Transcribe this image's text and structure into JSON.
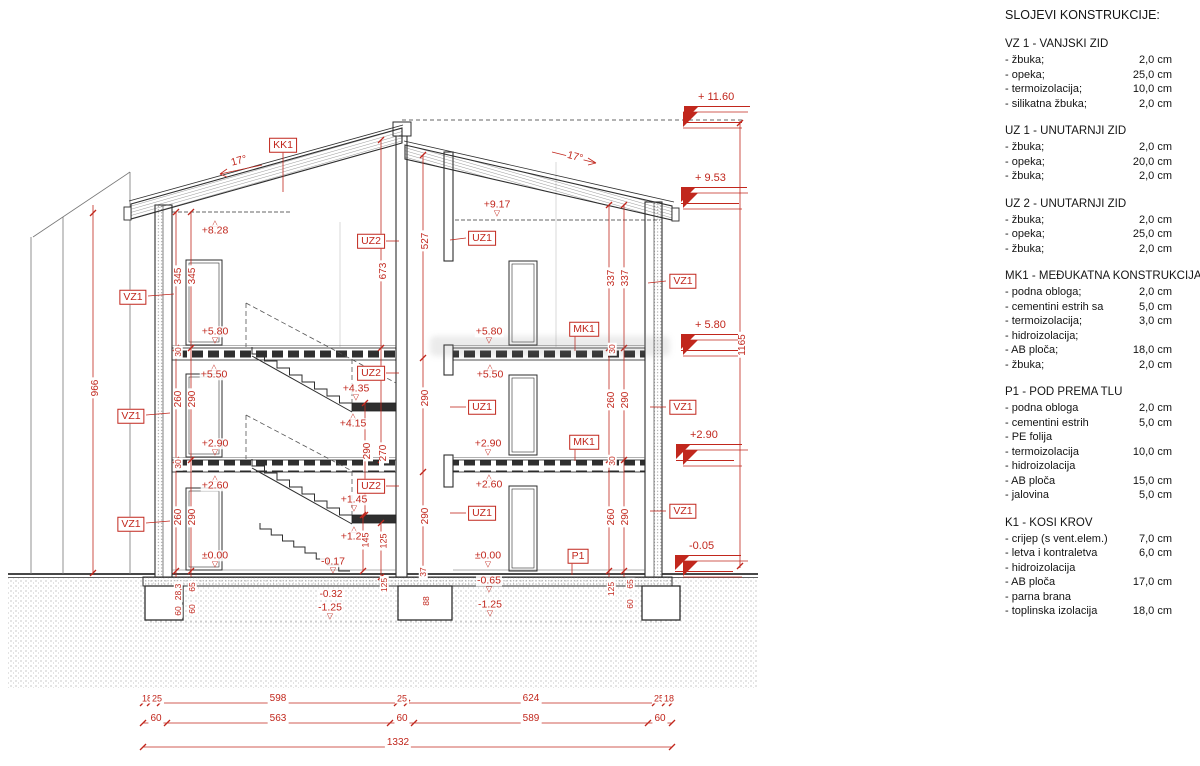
{
  "colors": {
    "annotation_red": "#c1271d",
    "line_black": "#2e2e2e",
    "background": "#ffffff"
  },
  "legend": {
    "title": "SLOJEVI KONSTRUKCIJE:",
    "sections": [
      {
        "heading": "VZ 1 - VANJSKI ZID",
        "rows": [
          {
            "label": "- žbuka;",
            "value": "2,0 cm"
          },
          {
            "label": "- opeka;",
            "value": "25,0 cm"
          },
          {
            "label": "- termoizolacija;",
            "value": "10,0 cm"
          },
          {
            "label": "- silikatna žbuka;",
            "value": "2,0 cm"
          }
        ]
      },
      {
        "heading": "UZ 1 - UNUTARNJI ZID",
        "rows": [
          {
            "label": "- žbuka;",
            "value": "2,0 cm"
          },
          {
            "label": "- opeka;",
            "value": "20,0 cm"
          },
          {
            "label": "- žbuka;",
            "value": "2,0 cm"
          }
        ]
      },
      {
        "heading": "UZ 2 - UNUTARNJI ZID",
        "rows": [
          {
            "label": "- žbuka;",
            "value": "2,0 cm"
          },
          {
            "label": "- opeka;",
            "value": "25,0 cm"
          },
          {
            "label": "- žbuka;",
            "value": "2,0 cm"
          }
        ]
      },
      {
        "heading": "MK1 - MEĐUKATNA KONSTRUKCIJA",
        "rows": [
          {
            "label": "- podna obloga;",
            "value": "2,0 cm"
          },
          {
            "label": "- cementini estrih sa",
            "value": "5,0 cm"
          },
          {
            "label": "- termoizolacija;",
            "value": "3,0 cm"
          },
          {
            "label": "- hidroizolacija;",
            "value": ""
          },
          {
            "label": "- AB ploča;",
            "value": "18,0 cm"
          },
          {
            "label": "- žbuka;",
            "value": "2,0 cm"
          }
        ]
      },
      {
        "heading": "P1 - POD PREMA TLU",
        "rows": [
          {
            "label": "- podna obloga",
            "value": "2,0 cm"
          },
          {
            "label": "- cementini estrih",
            "value": "5,0 cm"
          },
          {
            "label": "- PE folija",
            "value": ""
          },
          {
            "label": "- termoizolacija",
            "value": "10,0 cm"
          },
          {
            "label": "- hidroizolacija",
            "value": ""
          },
          {
            "label": "- AB ploča",
            "value": "15,0 cm"
          },
          {
            "label": "- jalovina",
            "value": "5,0 cm"
          }
        ]
      },
      {
        "heading": "K1 - KOSI KROV",
        "rows": [
          {
            "label": "- crijep (s vent.elem.)",
            "value": "7,0 cm"
          },
          {
            "label": "- letva i kontraletva",
            "value": "6,0 cm"
          },
          {
            "label": "- hidroizolacija",
            "value": ""
          },
          {
            "label": "- AB ploča",
            "value": "17,0 cm"
          },
          {
            "label": "- parna brana",
            "value": ""
          },
          {
            "label": "- toplinska izolacija",
            "value": "18,0 cm"
          }
        ]
      }
    ]
  },
  "annotations": [
    {
      "t": "KK1",
      "x": 283,
      "y": 145,
      "k": "box"
    },
    {
      "t": "VZ1",
      "x": 133,
      "y": 297,
      "k": "box"
    },
    {
      "t": "VZ1",
      "x": 131,
      "y": 416,
      "k": "box"
    },
    {
      "t": "VZ1",
      "x": 131,
      "y": 524,
      "k": "box"
    },
    {
      "t": "UZ2",
      "x": 371,
      "y": 241,
      "k": "box"
    },
    {
      "t": "UZ2",
      "x": 371,
      "y": 373,
      "k": "box"
    },
    {
      "t": "UZ2",
      "x": 371,
      "y": 486,
      "k": "box"
    },
    {
      "t": "UZ1",
      "x": 482,
      "y": 238,
      "k": "box"
    },
    {
      "t": "UZ1",
      "x": 482,
      "y": 407,
      "k": "box"
    },
    {
      "t": "UZ1",
      "x": 482,
      "y": 513,
      "k": "box"
    },
    {
      "t": "VZ1",
      "x": 683,
      "y": 281,
      "k": "box"
    },
    {
      "t": "VZ1",
      "x": 683,
      "y": 407,
      "k": "box"
    },
    {
      "t": "VZ1",
      "x": 683,
      "y": 511,
      "k": "box"
    },
    {
      "t": "MK1",
      "x": 584,
      "y": 329,
      "k": "box"
    },
    {
      "t": "MK1",
      "x": 584,
      "y": 442,
      "k": "box"
    },
    {
      "t": "P1",
      "x": 578,
      "y": 556,
      "k": "box"
    },
    {
      "t": "+9.17",
      "x": 497,
      "y": 207,
      "k": "ed"
    },
    {
      "t": "+8.28",
      "x": 215,
      "y": 228,
      "k": "eu"
    },
    {
      "t": "+5.80",
      "x": 215,
      "y": 334,
      "k": "ed"
    },
    {
      "t": "+5.80",
      "x": 489,
      "y": 334,
      "k": "ed"
    },
    {
      "t": "+5.50",
      "x": 214,
      "y": 372,
      "k": "eu"
    },
    {
      "t": "+5.50",
      "x": 490,
      "y": 372,
      "k": "eu"
    },
    {
      "t": "+2.90",
      "x": 215,
      "y": 446,
      "k": "ed"
    },
    {
      "t": "+2.90",
      "x": 488,
      "y": 446,
      "k": "ed"
    },
    {
      "t": "+2.60",
      "x": 215,
      "y": 483,
      "k": "eu"
    },
    {
      "t": "+2.60",
      "x": 489,
      "y": 482,
      "k": "eu"
    },
    {
      "t": "±0.00",
      "x": 215,
      "y": 558,
      "k": "ed"
    },
    {
      "t": "±0.00",
      "x": 488,
      "y": 558,
      "k": "ed"
    },
    {
      "t": "+4.35",
      "x": 356,
      "y": 391,
      "k": "ed"
    },
    {
      "t": "+4.15",
      "x": 353,
      "y": 421,
      "k": "eu"
    },
    {
      "t": "+1.45",
      "x": 354,
      "y": 502,
      "k": "ed"
    },
    {
      "t": "+1.25",
      "x": 354,
      "y": 534,
      "k": "eu"
    },
    {
      "t": "-0.17",
      "x": 333,
      "y": 564,
      "k": "ed"
    },
    {
      "t": "-0.32",
      "x": 331,
      "y": 595,
      "k": "dh"
    },
    {
      "t": "-1.25",
      "x": 330,
      "y": 610,
      "k": "ed"
    },
    {
      "t": "-0.65",
      "x": 489,
      "y": 583,
      "k": "ed"
    },
    {
      "t": "-1.25",
      "x": 490,
      "y": 607,
      "k": "ed"
    },
    {
      "t": "+ 11.60",
      "x": 717,
      "y": 100,
      "k": "mk"
    },
    {
      "t": "+ 9.53",
      "x": 714,
      "y": 181,
      "k": "mk"
    },
    {
      "t": "+ 5.80",
      "x": 714,
      "y": 328,
      "k": "mk"
    },
    {
      "t": "+2.90",
      "x": 709,
      "y": 438,
      "k": "mk"
    },
    {
      "t": "-0.05",
      "x": 708,
      "y": 549,
      "k": "mk"
    },
    {
      "t": "345",
      "x": 179,
      "y": 276,
      "k": "dv"
    },
    {
      "t": "345",
      "x": 193,
      "y": 276,
      "k": "dv"
    },
    {
      "t": "260",
      "x": 179,
      "y": 399,
      "k": "dv"
    },
    {
      "t": "290",
      "x": 193,
      "y": 399,
      "k": "dv"
    },
    {
      "t": "260",
      "x": 179,
      "y": 517,
      "k": "dv"
    },
    {
      "t": "290",
      "x": 193,
      "y": 517,
      "k": "dv"
    },
    {
      "t": "30",
      "x": 178,
      "y": 352,
      "k": "dv",
      "s": 8.5
    },
    {
      "t": "30",
      "x": 178,
      "y": 464,
      "k": "dv",
      "s": 8.5
    },
    {
      "t": "337",
      "x": 612,
      "y": 278,
      "k": "dv"
    },
    {
      "t": "337",
      "x": 626,
      "y": 278,
      "k": "dv"
    },
    {
      "t": "260",
      "x": 612,
      "y": 400,
      "k": "dv"
    },
    {
      "t": "290",
      "x": 626,
      "y": 400,
      "k": "dv"
    },
    {
      "t": "260",
      "x": 612,
      "y": 517,
      "k": "dv"
    },
    {
      "t": "290",
      "x": 626,
      "y": 517,
      "k": "dv"
    },
    {
      "t": "30",
      "x": 612,
      "y": 349,
      "k": "dv",
      "s": 8.5
    },
    {
      "t": "30",
      "x": 612,
      "y": 461,
      "k": "dv",
      "s": 8.5
    },
    {
      "t": "673",
      "x": 384,
      "y": 271,
      "k": "dv"
    },
    {
      "t": "527",
      "x": 426,
      "y": 241,
      "k": "dv"
    },
    {
      "t": "290",
      "x": 426,
      "y": 398,
      "k": "dv"
    },
    {
      "t": "290",
      "x": 368,
      "y": 451,
      "k": "dv"
    },
    {
      "t": "270",
      "x": 384,
      "y": 453,
      "k": "dv"
    },
    {
      "t": "290",
      "x": 426,
      "y": 516,
      "k": "dv"
    },
    {
      "t": "145",
      "x": 366,
      "y": 540,
      "k": "dv",
      "s": 9
    },
    {
      "t": "125",
      "x": 384,
      "y": 541,
      "k": "dv",
      "s": 9
    },
    {
      "t": "966",
      "x": 96,
      "y": 388,
      "k": "dv"
    },
    {
      "t": "1165",
      "x": 743,
      "y": 345,
      "k": "dv"
    },
    {
      "t": "28,3",
      "x": 178,
      "y": 592,
      "k": "dv",
      "s": 8.5
    },
    {
      "t": "60",
      "x": 178,
      "y": 611,
      "k": "dv",
      "s": 8.5
    },
    {
      "t": "65",
      "x": 192,
      "y": 587,
      "k": "dv",
      "s": 8.5
    },
    {
      "t": "60",
      "x": 192,
      "y": 609,
      "k": "dv",
      "s": 8.5
    },
    {
      "t": "37",
      "x": 423,
      "y": 572,
      "k": "dv",
      "s": 8.5
    },
    {
      "t": "88",
      "x": 426,
      "y": 601,
      "k": "dv",
      "s": 8.5
    },
    {
      "t": "125",
      "x": 384,
      "y": 585,
      "k": "dv",
      "s": 8.5
    },
    {
      "t": "125",
      "x": 611,
      "y": 589,
      "k": "dv",
      "s": 8.5
    },
    {
      "t": "65",
      "x": 630,
      "y": 584,
      "k": "dv",
      "s": 8.5
    },
    {
      "t": "60",
      "x": 630,
      "y": 604,
      "k": "dv",
      "s": 8.5
    },
    {
      "t": "18",
      "x": 147,
      "y": 699,
      "k": "dh",
      "s": 9
    },
    {
      "t": "25",
      "x": 157,
      "y": 699,
      "k": "dh",
      "s": 9
    },
    {
      "t": "598",
      "x": 278,
      "y": 699,
      "k": "dh"
    },
    {
      "t": "25",
      "x": 402,
      "y": 699,
      "k": "dh",
      "s": 9
    },
    {
      "t": "624",
      "x": 531,
      "y": 699,
      "k": "dh"
    },
    {
      "t": "25",
      "x": 659,
      "y": 699,
      "k": "dh",
      "s": 9
    },
    {
      "t": "18",
      "x": 669,
      "y": 699,
      "k": "dh",
      "s": 9
    },
    {
      "t": "60",
      "x": 156,
      "y": 719,
      "k": "dh"
    },
    {
      "t": "563",
      "x": 278,
      "y": 719,
      "k": "dh"
    },
    {
      "t": "60",
      "x": 402,
      "y": 719,
      "k": "dh"
    },
    {
      "t": "589",
      "x": 531,
      "y": 719,
      "k": "dh"
    },
    {
      "t": "60",
      "x": 660,
      "y": 719,
      "k": "dh"
    },
    {
      "t": "1332",
      "x": 398,
      "y": 743,
      "k": "dh"
    },
    {
      "t": "17°",
      "x": 239,
      "y": 161,
      "k": "ang",
      "r": -15
    },
    {
      "t": "17°",
      "x": 575,
      "y": 157,
      "k": "ang",
      "r": 15
    }
  ]
}
